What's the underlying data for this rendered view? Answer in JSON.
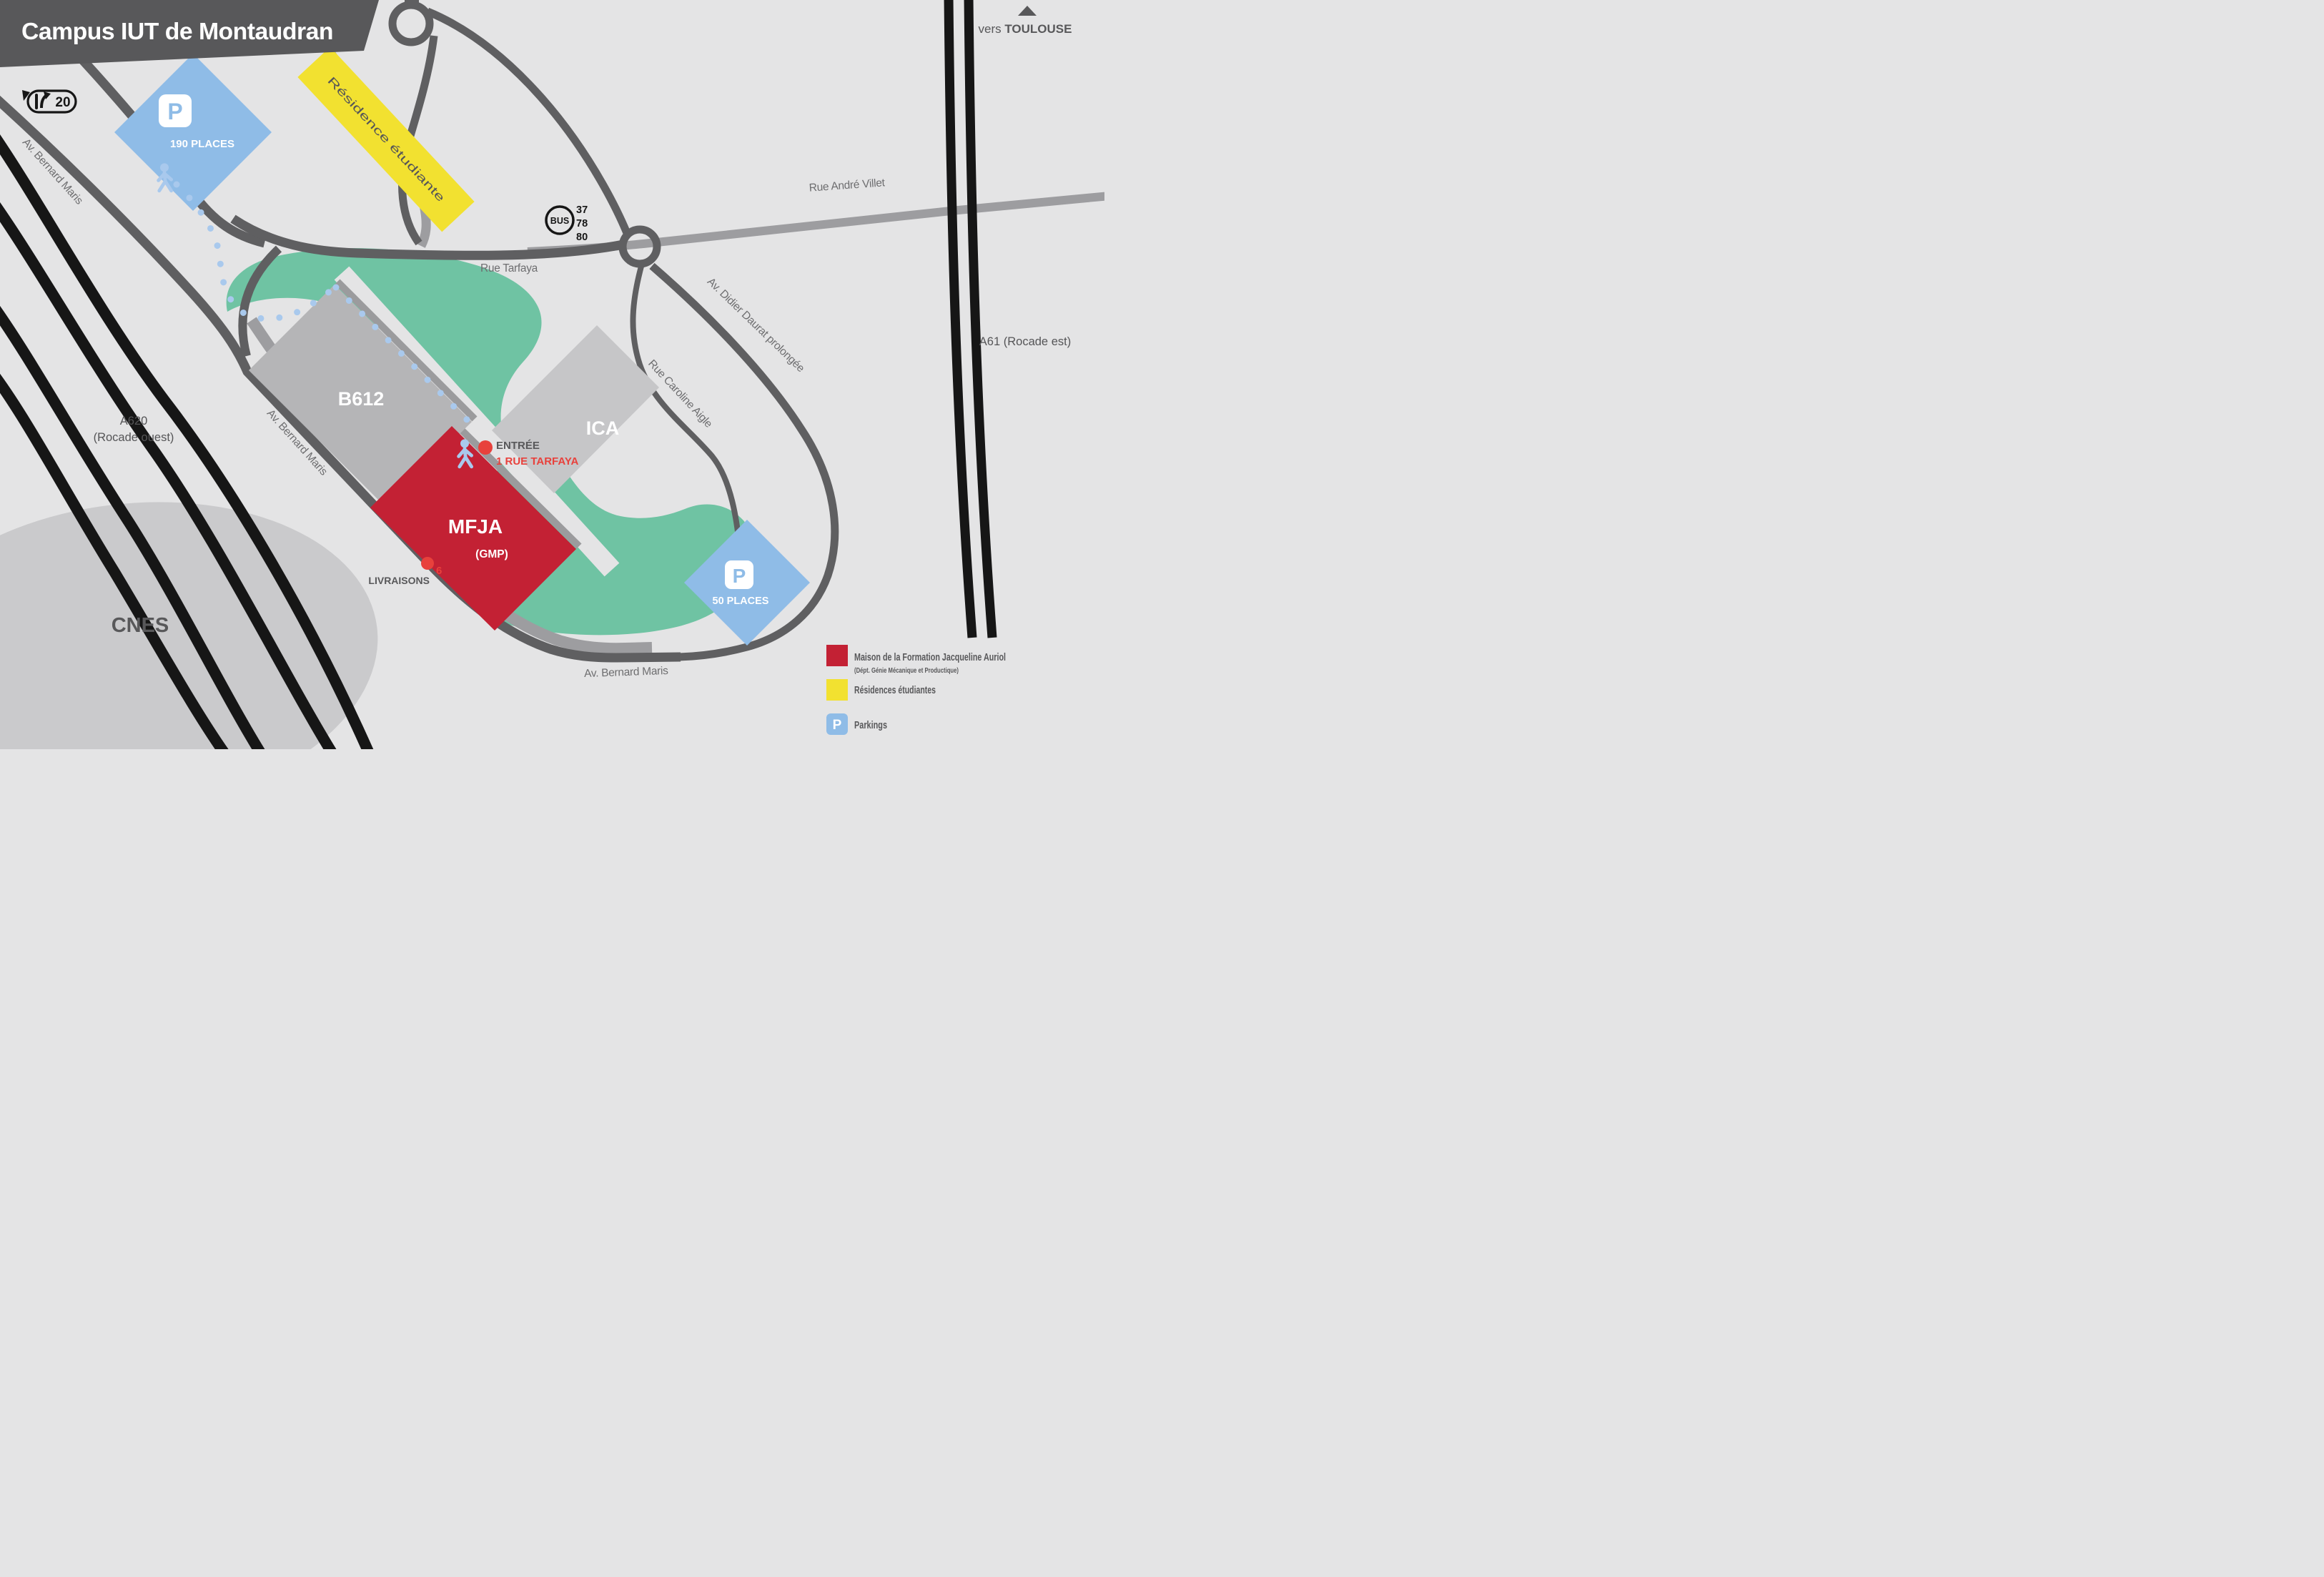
{
  "title": "Campus IUT de Montaudran",
  "colors": {
    "background": "#e4e4e5",
    "dark": "#58585a",
    "road_dark": "#5f5f61",
    "road_light": "#9d9da0",
    "black": "#161616",
    "green": "#6fc3a3",
    "red": "#c32134",
    "bright_red": "#e8413c",
    "yellow": "#f2e130",
    "parking_blue": "#8fbce7",
    "path_blue": "#a9c9ed",
    "building_gray": "#b5b5b7",
    "building_gray_light": "#c6c6c8",
    "cnes_gray": "#cacacc"
  },
  "directions": {
    "toulouse_prefix": "vers ",
    "toulouse_name": "TOULOUSE",
    "exit_number": "20"
  },
  "bus": {
    "label": "BUS",
    "lines": [
      "37",
      "78",
      "80"
    ]
  },
  "streets": {
    "bernard_maris_nw": "Av. Bernard Maris",
    "bernard_maris_mid": "Av. Bernard Maris",
    "bernard_maris_south": "Av. Bernard Maris",
    "tarfaya": "Rue Tarfaya",
    "andre_villet": "Rue André Villet",
    "didier_daurat": "Av. Didier Daurat prolongée",
    "caroline_aigle": "Rue Caroline Aigle",
    "a61": "A61 (Rocade est)",
    "a620_line1": "A620",
    "a620_line2": "(Rocade ouest)"
  },
  "buildings": {
    "b612": "B612",
    "ica": "ICA",
    "mfja": "MFJA",
    "mfja_dept": "(GMP)",
    "cnes": "CNES"
  },
  "areas": {
    "residence": "Résidence étudiante"
  },
  "parkings": {
    "p": "P",
    "north_capacity": "190 PLACES",
    "south_capacity": "50 PLACES"
  },
  "markers": {
    "entrance": "ENTRÉE",
    "entrance_address": "1 RUE TARFAYA",
    "deliveries": "LIVRAISONS",
    "deliveries_gate": "6"
  },
  "legend": {
    "mfja_label": "Maison de la Formation Jacqueline Auriol",
    "mfja_sub": "(Dépt. Génie Mécanique et Productique)",
    "residence_label": "Résidences étudiantes",
    "parking_label": "Parkings",
    "p": "P"
  }
}
